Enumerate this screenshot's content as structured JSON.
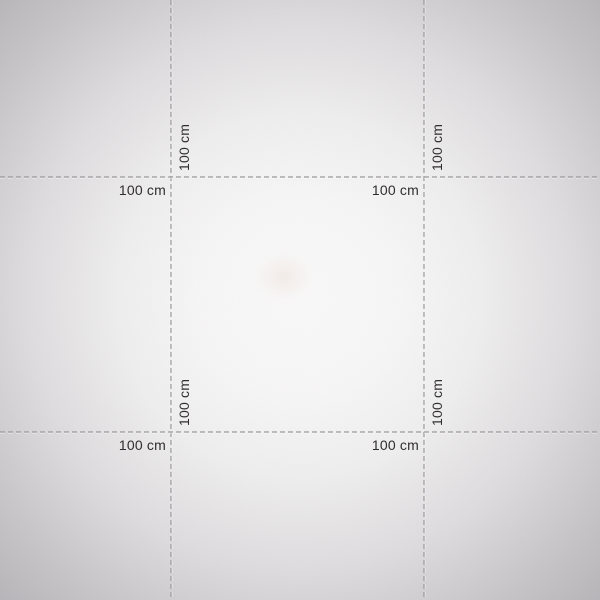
{
  "scene": {
    "width": 600,
    "height": 600,
    "background": {
      "center_color": "#faf9f9",
      "mid_color": "#dedcde",
      "edge_color": "#b0aeb2"
    },
    "smudge_color": "#e4cec0"
  },
  "guides": {
    "line_color": "#98969a",
    "highlight_color": "#ffffff",
    "dash": "5 3",
    "line_width": 1.2,
    "vertical_x": [
      171,
      424
    ],
    "horizontal_y": [
      177,
      432
    ],
    "measurement_text": "100 cm"
  },
  "measurements": [
    {
      "orientation": "vertical",
      "at_vertical_x": 171,
      "at_horizontal_y": 177,
      "text": "100 cm"
    },
    {
      "orientation": "horizontal",
      "at_vertical_x": 171,
      "at_horizontal_y": 177,
      "text": "100 cm"
    },
    {
      "orientation": "vertical",
      "at_vertical_x": 424,
      "at_horizontal_y": 177,
      "text": "100 cm"
    },
    {
      "orientation": "horizontal",
      "at_vertical_x": 424,
      "at_horizontal_y": 177,
      "text": "100 cm"
    },
    {
      "orientation": "vertical",
      "at_vertical_x": 171,
      "at_horizontal_y": 432,
      "text": "100 cm"
    },
    {
      "orientation": "horizontal",
      "at_vertical_x": 171,
      "at_horizontal_y": 432,
      "text": "100 cm"
    },
    {
      "orientation": "vertical",
      "at_vertical_x": 424,
      "at_horizontal_y": 432,
      "text": "100 cm"
    },
    {
      "orientation": "horizontal",
      "at_vertical_x": 424,
      "at_horizontal_y": 432,
      "text": "100 cm"
    }
  ]
}
